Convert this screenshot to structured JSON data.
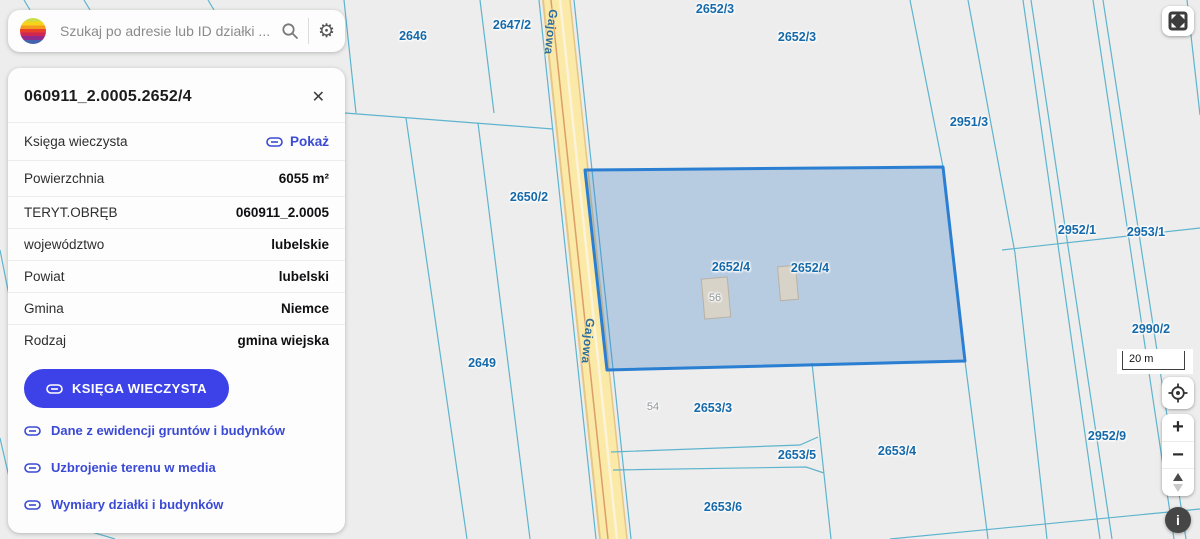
{
  "search": {
    "placeholder": "Szukaj po adresie lub ID działki ..."
  },
  "panel": {
    "title": "060911_2.0005.2652/4",
    "close_glyph": "✕",
    "kw_row": {
      "label": "Księga wieczysta",
      "link": "Pokaż"
    },
    "rows": [
      {
        "label": "Powierzchnia",
        "value": "6055 m²"
      },
      {
        "label": "TERYT.OBRĘB",
        "value": "060911_2.0005"
      },
      {
        "label": "województwo",
        "value": "lubelskie"
      },
      {
        "label": "Powiat",
        "value": "lubelski"
      },
      {
        "label": "Gmina",
        "value": "Niemce"
      },
      {
        "label": "Rodzaj",
        "value": "gmina wiejska"
      }
    ],
    "button": "KSIĘGA WIECZYSTA",
    "links": [
      "Dane z ewidencji gruntów i budynków",
      "Uzbrojenie terenu w media",
      "Wymiary działki i budynków"
    ]
  },
  "map": {
    "selected_parcel_id": "2652/4",
    "labels": [
      "2646",
      "2647/2",
      "2652/3",
      "2652/3",
      "2951/3",
      "2650/2",
      "2952/1",
      "2953/1",
      "2652/4",
      "2652/4",
      "2990/2",
      "2649",
      "2653/3",
      "2952/9",
      "2653/4",
      "2653/5",
      "2653/6",
      "54",
      "56"
    ],
    "road_labels": [
      "Gajowa",
      "Gajowa"
    ],
    "scale": "20 m",
    "colors": {
      "selection_stroke": "#2b7fd2",
      "selection_fill": "rgba(58,125,200,0.30)",
      "parcel_line": "#57b2cd",
      "road_fill": "#fbe9a7",
      "label_text": "#1569a9"
    }
  },
  "controls": {
    "zoom_in": "+",
    "zoom_out": "−",
    "info": "i"
  }
}
